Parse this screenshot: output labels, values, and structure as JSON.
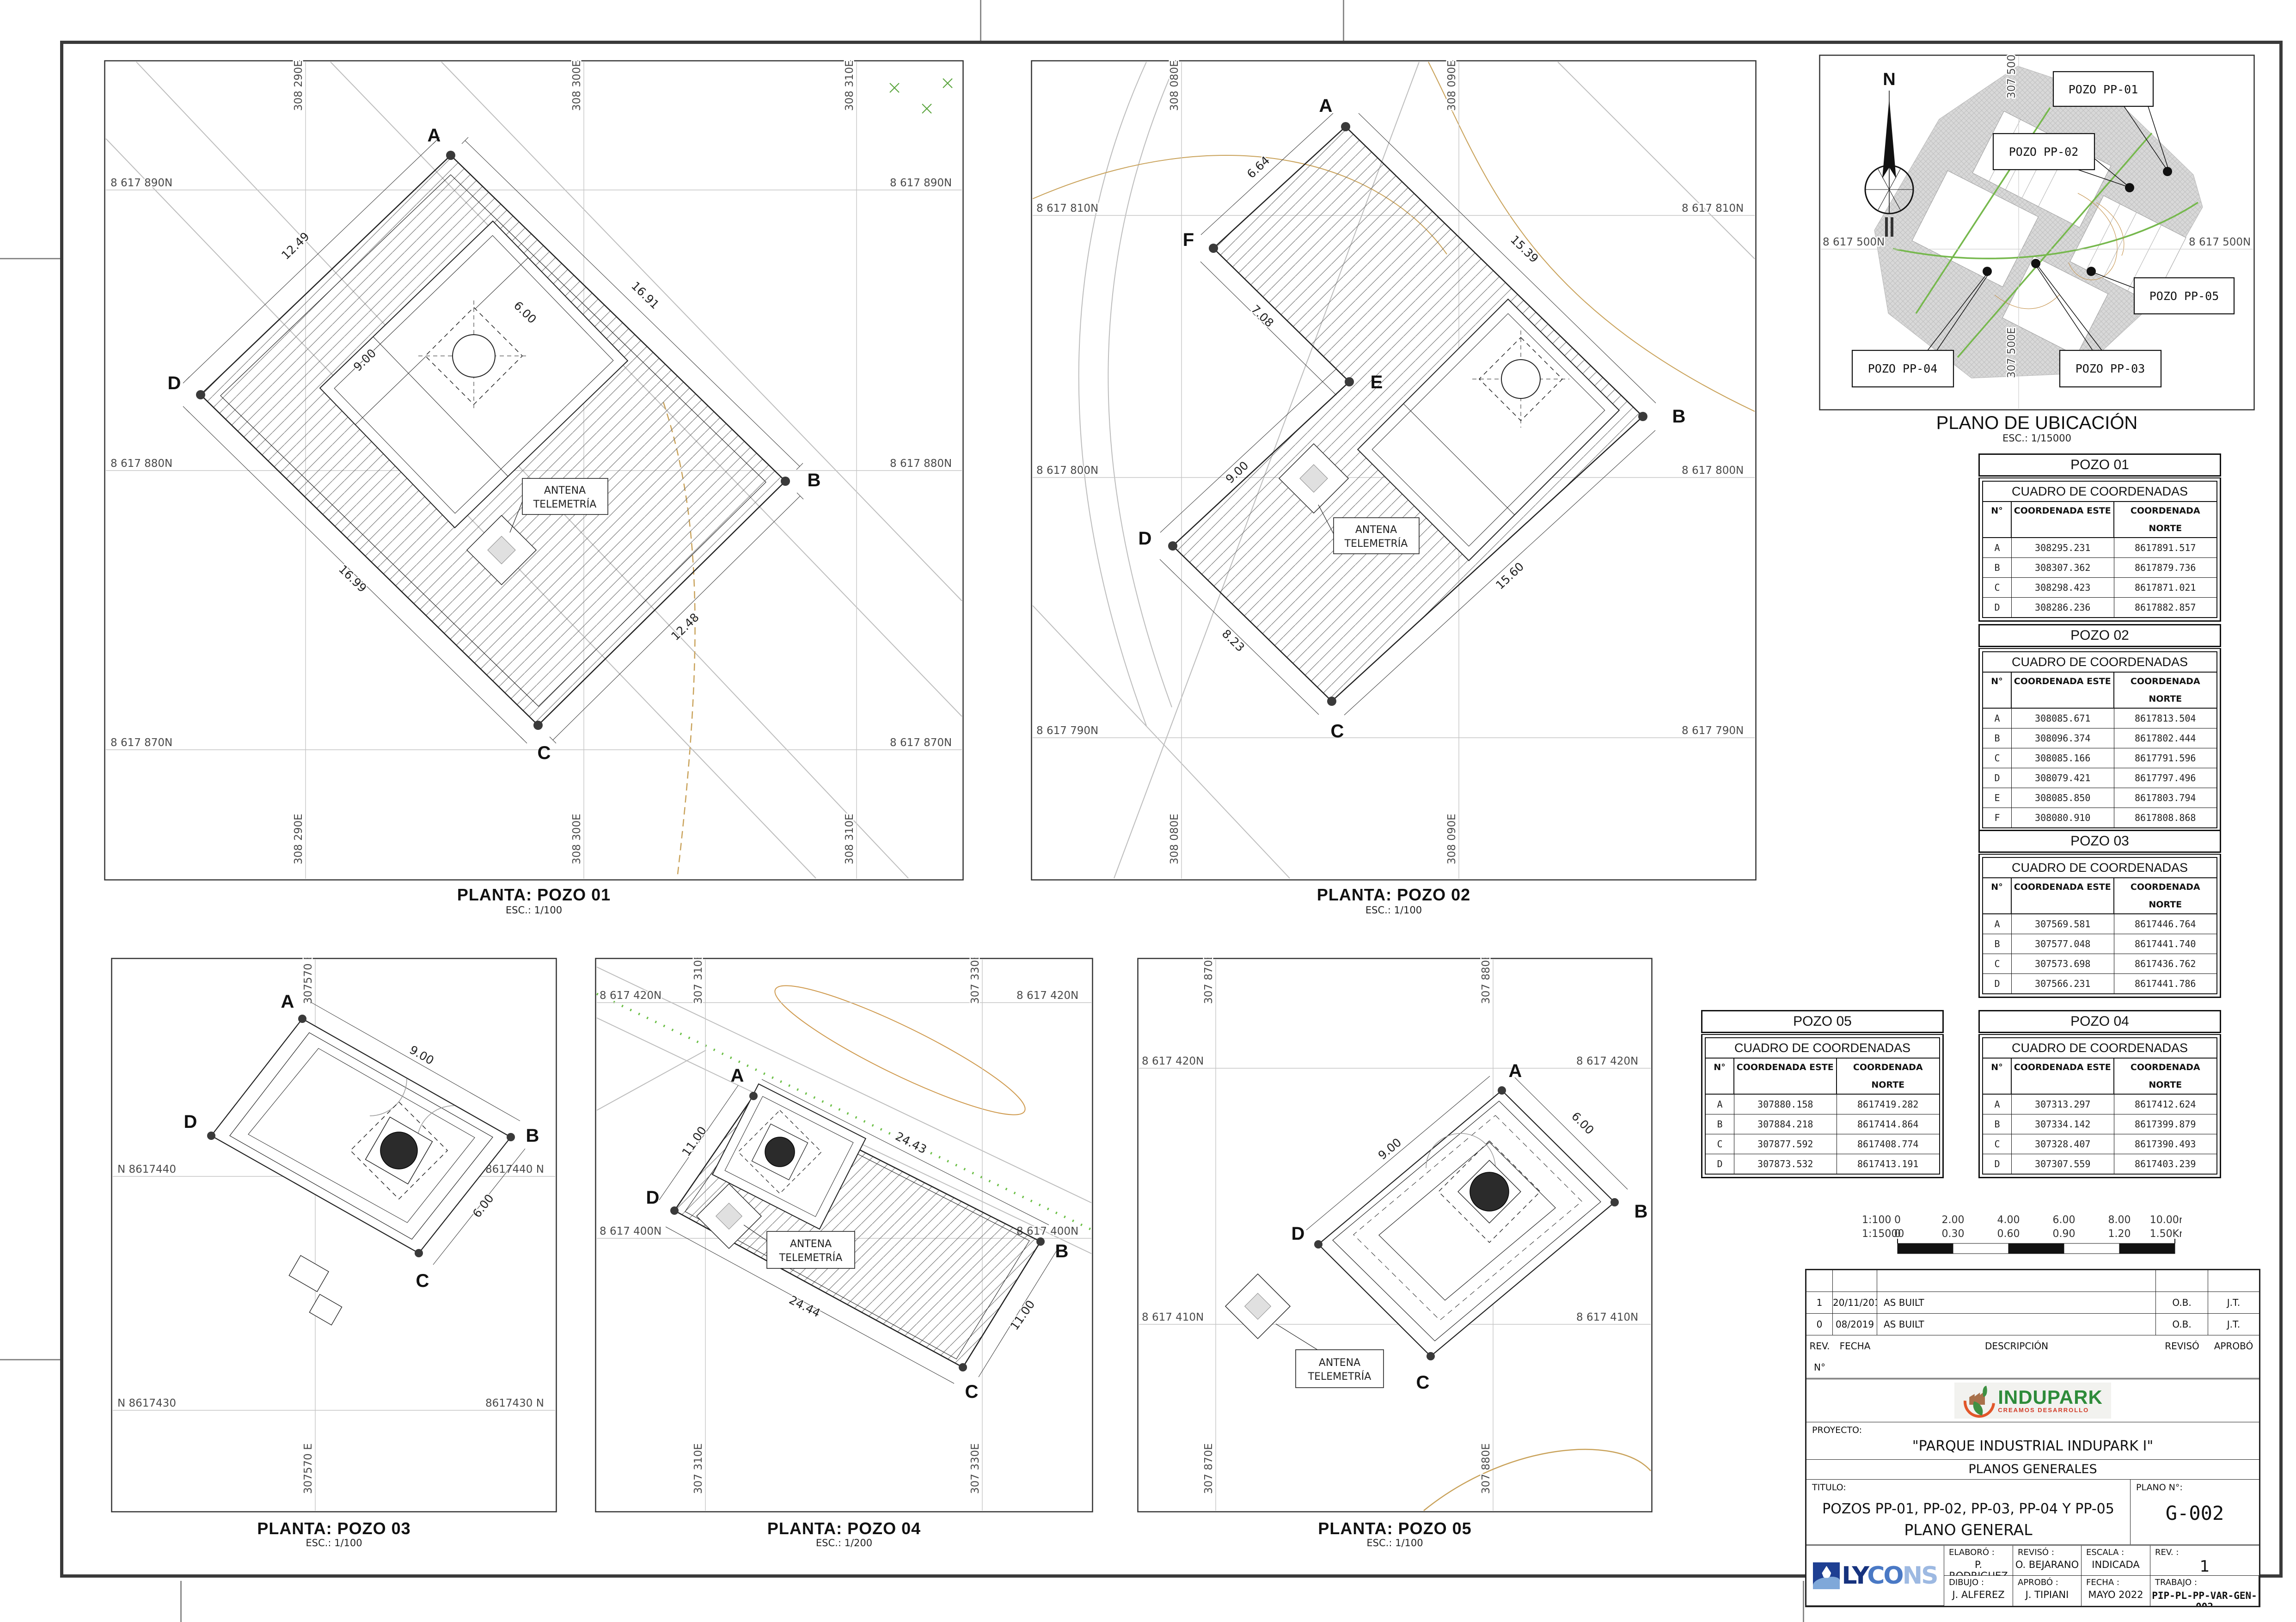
{
  "location_plan": {
    "title": "PLANO DE UBICACIÓN",
    "scale": "ESC.: 1/15000",
    "north": "N",
    "labels": {
      "pp01": "POZO PP-01",
      "pp02": "POZO PP-02",
      "pp03": "POZO PP-03",
      "pp04": "POZO PP-04",
      "pp05": "POZO PP-05"
    },
    "coord_n": "8 617 500N",
    "coord_e": "307 500E"
  },
  "plans": [
    {
      "title": "PLANTA: POZO 01",
      "scale": "ESC.: 1/100",
      "antena1": "ANTENA",
      "antena2": "TELEMETRÍA",
      "cols": [
        "308 290E",
        "308 300E",
        "308 310E"
      ],
      "rows": [
        "8 617 890N",
        "8 617 880N",
        "8 617 870N"
      ],
      "v": [
        "A",
        "B",
        "C",
        "D"
      ],
      "dims": [
        "12.49",
        "16.91",
        "16.99",
        "12.48",
        "9.00",
        "6.00"
      ]
    },
    {
      "title": "PLANTA: POZO 02",
      "scale": "ESC.: 1/100",
      "antena1": "ANTENA",
      "antena2": "TELEMETRÍA",
      "cols": [
        "308 080E",
        "308 090E"
      ],
      "rows": [
        "8 617 810N",
        "8 617 800N",
        "8 617 790N"
      ],
      "v": [
        "A",
        "B",
        "C",
        "D",
        "E",
        "F"
      ],
      "dims": [
        "6.64",
        "15.39",
        "7.08",
        "9.00",
        "8.23",
        "15.60"
      ]
    },
    {
      "title": "PLANTA: POZO 03",
      "scale": "ESC.: 1/100",
      "cols": [
        "307570 E"
      ],
      "rows_left": [
        "N 8617440",
        "N 8617430"
      ],
      "rows_right": [
        "8617440 N",
        "8617430 N"
      ],
      "v": [
        "A",
        "B",
        "C",
        "D"
      ],
      "dims": [
        "9.00",
        "6.00"
      ]
    },
    {
      "title": "PLANTA: POZO 04",
      "scale": "ESC.: 1/200",
      "antena1": "ANTENA",
      "antena2": "TELEMETRÍA",
      "cols": [
        "307 310E",
        "307 330E"
      ],
      "rows": [
        "8 617 420N",
        "8 617 400N"
      ],
      "v": [
        "A",
        "B",
        "C",
        "D"
      ],
      "dims": [
        "11.00",
        "24.43",
        "24.44",
        "11.00"
      ]
    },
    {
      "title": "PLANTA: POZO 05",
      "scale": "ESC.: 1/100",
      "antena1": "ANTENA",
      "antena2": "TELEMETRÍA",
      "cols": [
        "307 870E",
        "307 880E"
      ],
      "rows": [
        "8 617 420N",
        "8 617 410N"
      ],
      "v": [
        "A",
        "B",
        "C",
        "D"
      ],
      "dims": [
        "9.00",
        "6.00"
      ]
    }
  ],
  "tables": [
    {
      "title": "POZO 01",
      "subtitle": "CUADRO DE COORDENADAS",
      "headers": [
        "N°",
        "COORDENADA ESTE",
        "COORDENADA NORTE"
      ],
      "rows": [
        [
          "A",
          "308295.231",
          "8617891.517"
        ],
        [
          "B",
          "308307.362",
          "8617879.736"
        ],
        [
          "C",
          "308298.423",
          "8617871.021"
        ],
        [
          "D",
          "308286.236",
          "8617882.857"
        ]
      ]
    },
    {
      "title": "POZO 02",
      "subtitle": "CUADRO DE COORDENADAS",
      "headers": [
        "N°",
        "COORDENADA ESTE",
        "COORDENADA NORTE"
      ],
      "rows": [
        [
          "A",
          "308085.671",
          "8617813.504"
        ],
        [
          "B",
          "308096.374",
          "8617802.444"
        ],
        [
          "C",
          "308085.166",
          "8617791.596"
        ],
        [
          "D",
          "308079.421",
          "8617797.496"
        ],
        [
          "E",
          "308085.850",
          "8617803.794"
        ],
        [
          "F",
          "308080.910",
          "8617808.868"
        ]
      ]
    },
    {
      "title": "POZO 03",
      "subtitle": "CUADRO DE COORDENADAS",
      "headers": [
        "N°",
        "COORDENADA ESTE",
        "COORDENADA NORTE"
      ],
      "rows": [
        [
          "A",
          "307569.581",
          "8617446.764"
        ],
        [
          "B",
          "307577.048",
          "8617441.740"
        ],
        [
          "C",
          "307573.698",
          "8617436.762"
        ],
        [
          "D",
          "307566.231",
          "8617441.786"
        ]
      ]
    },
    {
      "title": "POZO 04",
      "subtitle": "CUADRO DE COORDENADAS",
      "headers": [
        "N°",
        "COORDENADA ESTE",
        "COORDENADA NORTE"
      ],
      "rows": [
        [
          "A",
          "307313.297",
          "8617412.624"
        ],
        [
          "B",
          "307334.142",
          "8617399.879"
        ],
        [
          "C",
          "307328.407",
          "8617390.493"
        ],
        [
          "D",
          "307307.559",
          "8617403.239"
        ]
      ]
    },
    {
      "title": "POZO 05",
      "subtitle": "CUADRO DE COORDENADAS",
      "headers": [
        "N°",
        "COORDENADA ESTE",
        "COORDENADA NORTE"
      ],
      "rows": [
        [
          "A",
          "307880.158",
          "8617419.282"
        ],
        [
          "B",
          "307884.218",
          "8617414.864"
        ],
        [
          "C",
          "307877.592",
          "8617408.774"
        ],
        [
          "D",
          "307873.532",
          "8617413.191"
        ]
      ]
    }
  ],
  "scalebar": {
    "scale1": "1:100",
    "ticks1": [
      "0",
      "2.00",
      "4.00",
      "6.00",
      "8.00",
      "10.00m"
    ],
    "scale2": "1:15000",
    "ticks2": [
      "0",
      "0.30",
      "0.60",
      "0.90",
      "1.20",
      "1.50Km"
    ]
  },
  "titleblock": {
    "rev_rows": [
      [
        "1",
        "20/11/2019",
        "AS BUILT",
        "O.B.",
        "J.T."
      ],
      [
        "0",
        "08/2019",
        "AS BUILT",
        "O.B.",
        "J.T."
      ]
    ],
    "rev_headers": [
      "REV. N°",
      "FECHA",
      "DESCRIPCIÓN",
      "REVISÓ",
      "APROBÓ"
    ],
    "brand": {
      "name": "INDUPARK",
      "tagline": "CREAMOS DESARROLLO"
    },
    "proyecto_label": "PROYECTO:",
    "proyecto": "\"PARQUE INDUSTRIAL INDUPARK I\"",
    "seccion": "PLANOS GENERALES",
    "titulo_label": "TITULO:",
    "titulo1": "POZOS PP-01, PP-02, PP-03, PP-04 Y PP-05",
    "titulo2": "PLANO GENERAL",
    "plano_label": "PLANO N°:",
    "plano_num": "G-002",
    "lycons": {
      "p1": "LY",
      "p2": "CO",
      "p3": "NS"
    },
    "fields": {
      "elaboro_label": "ELABORÓ :",
      "elaboro": "P. RODRIGUEZ",
      "reviso_label": "REVISÓ :",
      "reviso": "O. BEJARANO",
      "escala_label": "ESCALA :",
      "escala": "INDICADA",
      "rev_label": "REV. :",
      "rev": "1",
      "dibujo_label": "DIBUJO :",
      "dibujo": "J. ALFEREZ",
      "aprobo_label": "APROBÓ :",
      "aprobo": "J. TIPIANI",
      "fecha_label": "FECHA :",
      "fecha": "MAYO 2022",
      "trabajo_label": "TRABAJO :",
      "trabajo": "PIP-PL-PP-VAR-GEN-002"
    }
  }
}
